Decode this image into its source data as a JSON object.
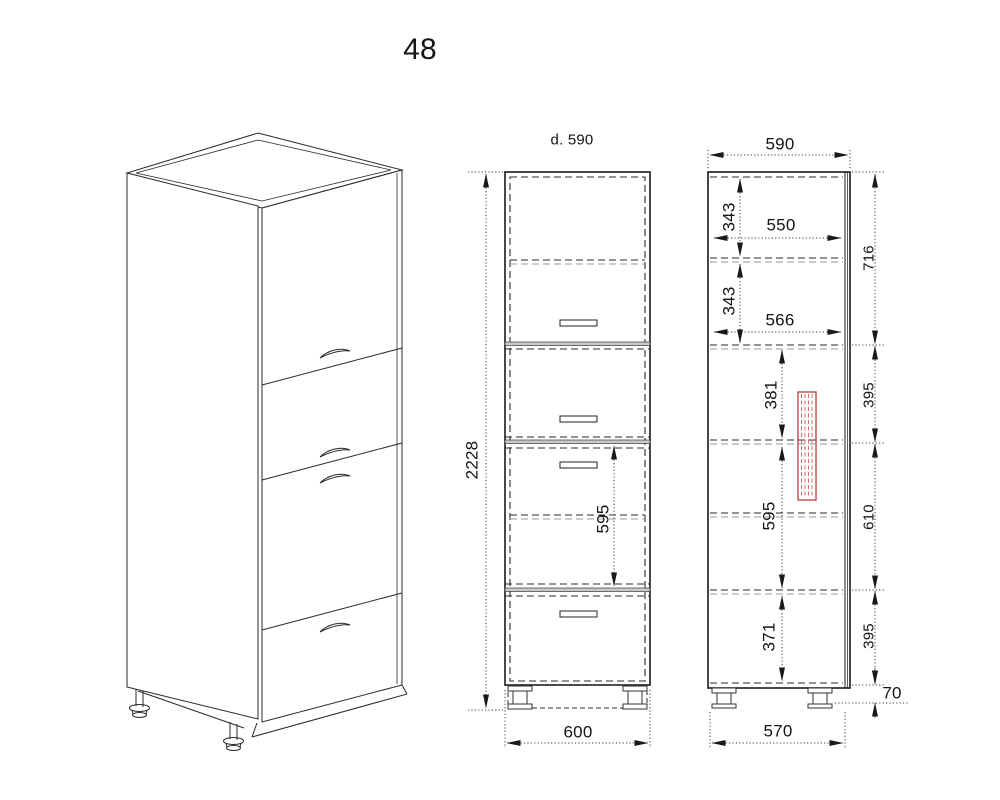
{
  "title": "48",
  "labels": {
    "front_view": {
      "depth_note": "d. 590",
      "total_height": "2228",
      "drawer_section_height": "595",
      "overall_width": "600"
    },
    "side_view": {
      "overall_depth": "590",
      "top_to_first_shelf": "343",
      "upper_shelf_depth": "550",
      "shelf_to_divider": "343",
      "lower_shelf_depth": "566",
      "divider_to_mid_shelf": "381",
      "mid_section_height": "595",
      "bottom_section_height": "371",
      "chain_top_section": "716",
      "chain_upper_mid_section": "395",
      "chain_mid_section": "610",
      "chain_lower_section": "395",
      "plinth_height": "70",
      "base_depth": "570"
    }
  },
  "colors": {
    "line": "#1a1a1a",
    "dashed_gray": "#9a9a9a",
    "dimension": "#3c3c3c",
    "highlight": "#c24b48",
    "background": "#ffffff"
  }
}
